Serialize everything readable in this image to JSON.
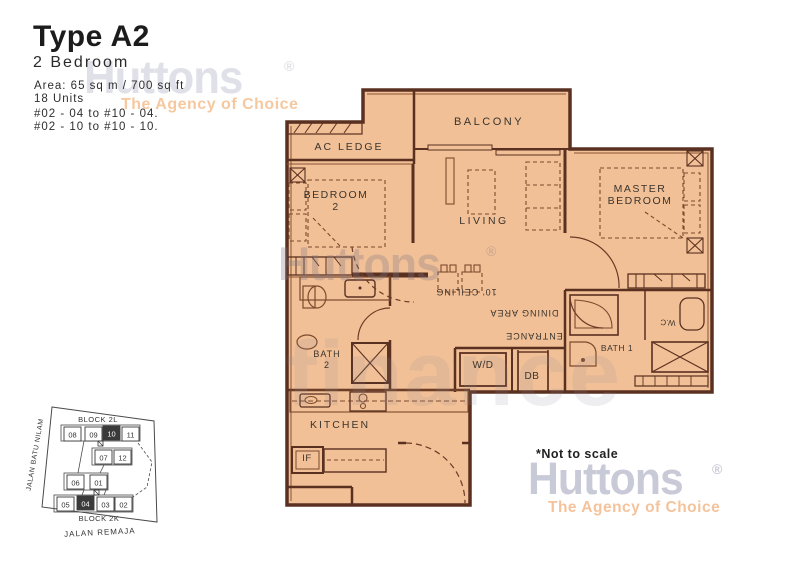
{
  "header": {
    "type_title": "Type A2",
    "subtitle": "2 Bedroom",
    "area": "Area: 65 sq m / 700 sq ft",
    "unit_count": "18 Units",
    "stack_line1": "#02 - 04 to #10 - 04.",
    "stack_line2": "#02 - 10 to #10 - 10."
  },
  "brand": {
    "name": "Huttons",
    "registered": "®",
    "tagline": "The Agency of Choice",
    "logo_color": "#c9cad8",
    "tagline_color": "#f4c39b"
  },
  "watermark": {
    "script_word": "finance"
  },
  "note": "*Not to scale",
  "plan": {
    "fill_color": "#f2c096",
    "wall_color": "#5a3020",
    "rooms": {
      "balcony": "BALCONY",
      "ac_ledge": "AC LEDGE",
      "bedroom2_line1": "BEDROOM",
      "bedroom2_line2": "2",
      "living": "LIVING",
      "master_line1": "MASTER",
      "master_line2": "BEDROOM",
      "kitchen": "KITCHEN",
      "bath2_line1": "BATH",
      "bath2_line2": "2",
      "bath1": "BATH 1",
      "wc": "W.C"
    },
    "fixtures": {
      "washer_dryer": "W/D",
      "db_box": "DB",
      "fridge": "IF"
    },
    "dining_labels_rotated": [
      {
        "text": "10' CEILING"
      },
      {
        "text": "DINING AREA"
      },
      {
        "text": "ENTRANCE"
      }
    ]
  },
  "siteplan": {
    "block_top": "BLOCK 2L",
    "block_bottom": "BLOCK 2K",
    "road_bottom": "JALAN REMAJA",
    "road_left": "JALAN BATU NILAM",
    "units": [
      "08",
      "09",
      "10",
      "11",
      "07",
      "12",
      "06",
      "01",
      "05",
      "04",
      "03",
      "02"
    ],
    "highlighted_units": [
      "10",
      "04"
    ]
  }
}
